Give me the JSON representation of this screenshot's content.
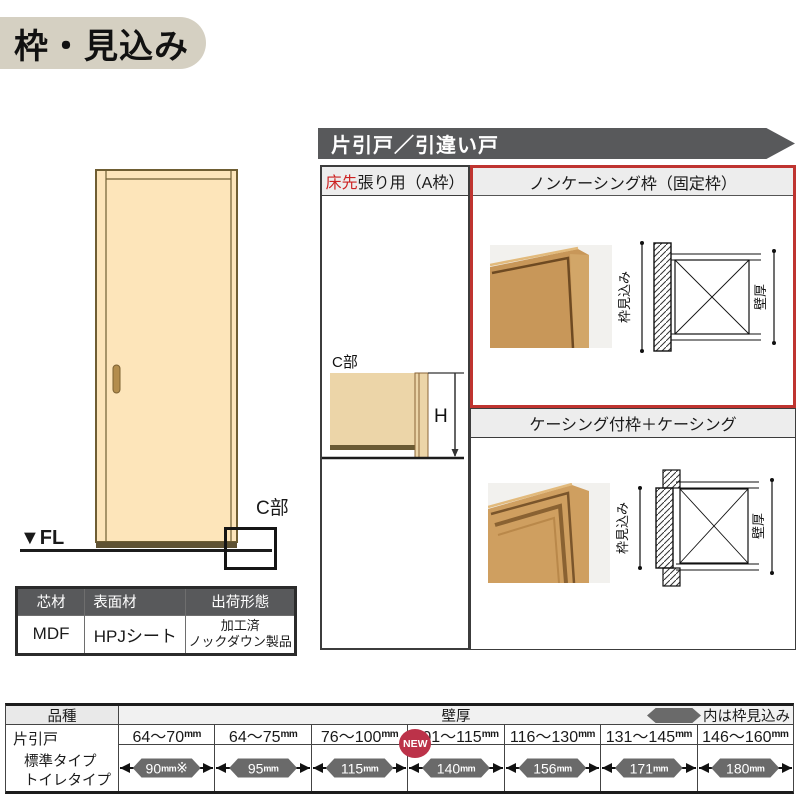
{
  "page": {
    "title": "枠・見込み"
  },
  "banner": {
    "title": "片引戸／引違い戸"
  },
  "door_figure": {
    "fl_label": "▼FL",
    "c_callout_label": "C部"
  },
  "materials_table": {
    "headers": [
      "芯材",
      "表面材",
      "出荷形態"
    ],
    "core_value": "MDF",
    "surface_value": "HPJシート",
    "shipping_line1": "加工済",
    "shipping_line2": "ノックダウン製品"
  },
  "panel": {
    "left": {
      "header_highlight": "床先",
      "header_rest": "張り用（A枠）",
      "detail_label": "C部",
      "height_label": "H"
    },
    "noncasing": {
      "header": "ノンケーシング枠（固定枠）",
      "dim_depth": "枠見込み",
      "dim_wall": "壁厚"
    },
    "casing": {
      "header": "ケーシング付枠＋ケーシング",
      "dim_depth": "枠見込み",
      "dim_wall": "壁厚"
    }
  },
  "spec_table": {
    "kind_header": "品種",
    "wall_header": "壁厚",
    "legend_label": "内は枠見込み",
    "row_label_1": "片引戸",
    "row_label_2": "標準タイプ",
    "row_label_3": "トイレタイプ",
    "unit": "mm",
    "new_badge": "NEW",
    "columns": [
      {
        "range": "64～70",
        "value": "90",
        "suffix": "※"
      },
      {
        "range": "64～75",
        "value": "95",
        "suffix": ""
      },
      {
        "range": "76～100",
        "value": "115",
        "suffix": ""
      },
      {
        "range": "101～115",
        "value": "140",
        "suffix": ""
      },
      {
        "range": "116～130",
        "value": "156",
        "suffix": ""
      },
      {
        "range": "131～145",
        "value": "171",
        "suffix": ""
      },
      {
        "range": "146～160",
        "value": "180",
        "suffix": ""
      }
    ],
    "colors": {
      "badge": "#6a6a6a",
      "new": "#bc3249",
      "header_bg": "#ededed"
    }
  }
}
